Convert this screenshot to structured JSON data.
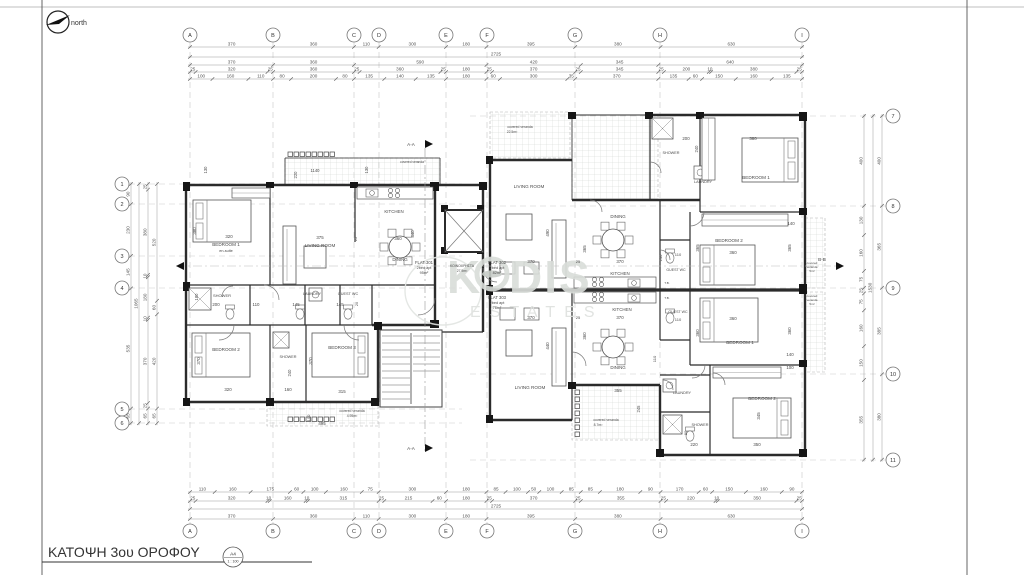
{
  "page": {
    "title": "ΚΑΤΟΨΗ 3ου ΟΡΟΦΟΥ",
    "sheet": "A4",
    "scale_ratio": "1 : 100",
    "north_label": "north"
  },
  "watermark": {
    "brand_k": "K",
    "brand_dis": "DIS",
    "tagline": "ESTATES"
  },
  "grid": {
    "cols": {
      "labels": [
        "A",
        "B",
        "C",
        "D",
        "E",
        "F",
        "G",
        "H",
        "I"
      ],
      "x": [
        190,
        273,
        354,
        379,
        446,
        487,
        575,
        660,
        802
      ]
    },
    "rows_left": {
      "labels": [
        "1",
        "2",
        "3",
        "4",
        "5",
        "6"
      ],
      "y": [
        184,
        204,
        256,
        288,
        409,
        423
      ]
    },
    "rows_right": {
      "labels": [
        "7",
        "8",
        "9",
        "10",
        "11"
      ],
      "y": [
        116,
        206,
        288,
        374,
        460
      ]
    }
  },
  "dim_chains": [
    {
      "name": "top-row-1",
      "dir": "h",
      "x": 190,
      "y": 47,
      "values": [
        370,
        360,
        110,
        300,
        180,
        395,
        380,
        630
      ]
    },
    {
      "name": "top-total",
      "dir": "h",
      "x": 190,
      "y": 57,
      "values": [
        2725
      ]
    },
    {
      "name": "top-row-3",
      "dir": "h",
      "x": 190,
      "y": 65,
      "values": [
        370,
        360,
        590,
        420,
        345,
        640
      ]
    },
    {
      "name": "top-row-4",
      "dir": "h",
      "x": 190,
      "y": 72,
      "values": [
        25,
        320,
        25,
        360,
        25,
        360,
        25,
        180,
        25,
        370,
        25,
        345,
        25,
        200,
        10,
        380,
        25
      ]
    },
    {
      "name": "top-row-5",
      "dir": "h",
      "x": 190,
      "y": 79,
      "values": [
        100,
        160,
        110,
        80,
        200,
        80,
        135,
        140,
        135,
        180,
        60,
        300,
        35,
        370,
        135,
        60,
        150,
        160,
        135
      ]
    },
    {
      "name": "bottom-row-1",
      "dir": "h",
      "x": 190,
      "y": 492,
      "values": [
        110,
        160,
        175,
        60,
        100,
        160,
        75,
        300,
        180,
        85,
        100,
        50,
        100,
        85,
        85,
        180,
        90,
        170,
        60,
        150,
        160,
        90
      ]
    },
    {
      "name": "bottom-row-2",
      "dir": "h",
      "x": 190,
      "y": 501,
      "values": [
        25,
        320,
        10,
        160,
        10,
        315,
        25,
        215,
        60,
        180,
        25,
        370,
        25,
        355,
        25,
        220,
        10,
        350,
        25
      ]
    },
    {
      "name": "bottom-total",
      "dir": "h",
      "x": 190,
      "y": 509,
      "values": [
        2725
      ]
    },
    {
      "name": "bottom-row-4",
      "dir": "h",
      "x": 190,
      "y": 519,
      "values": [
        370,
        360,
        110,
        300,
        180,
        395,
        380,
        630
      ]
    },
    {
      "name": "left-outer",
      "dir": "v",
      "x": 131,
      "y": 184,
      "values": [
        90,
        230,
        145,
        535,
        65
      ]
    },
    {
      "name": "left-total",
      "dir": "v",
      "x": 139,
      "y": 184,
      "values": [
        1065
      ]
    },
    {
      "name": "left-inner",
      "dir": "v",
      "x": 148,
      "y": 184,
      "values": [
        25,
        380,
        10,
        180,
        10,
        370,
        25,
        65
      ]
    },
    {
      "name": "left-room",
      "dir": "v",
      "x": 157,
      "y": 184,
      "values": [
        520,
        60,
        420,
        65
      ]
    },
    {
      "name": "right-inner",
      "dir": "v",
      "x": 864,
      "y": 116,
      "values": [
        400,
        130,
        160,
        75,
        25,
        75,
        160,
        150,
        355
      ]
    },
    {
      "name": "right-total",
      "dir": "v",
      "x": 873,
      "y": 116,
      "values": [
        1530
      ]
    },
    {
      "name": "right-outer",
      "dir": "v",
      "x": 882,
      "y": 116,
      "values": [
        400,
        365,
        385,
        380
      ]
    }
  ],
  "labels": [
    {
      "t": "1140",
      "x": 315,
      "y": 172,
      "s": 4.2
    },
    {
      "t": "220",
      "x": 297,
      "y": 175,
      "s": 4.2,
      "r": -90
    },
    {
      "t": "130",
      "x": 207,
      "y": 170,
      "s": 4.2,
      "r": -90
    },
    {
      "t": "130",
      "x": 368,
      "y": 170,
      "s": 4.2,
      "r": -90
    },
    {
      "t": "covered veranda",
      "x": 412,
      "y": 163,
      "s": 3.2
    },
    {
      "t": "BEDROOM 1",
      "x": 226,
      "y": 246,
      "s": 4.6
    },
    {
      "t": "en-suite",
      "x": 226,
      "y": 252,
      "s": 3.8
    },
    {
      "t": "320",
      "x": 229,
      "y": 238,
      "s": 4.4
    },
    {
      "t": "380",
      "x": 196,
      "y": 231,
      "s": 4.4,
      "r": -90
    },
    {
      "t": "LIVING ROOM",
      "x": 320,
      "y": 247,
      "s": 4.6
    },
    {
      "t": "375",
      "x": 320,
      "y": 239,
      "s": 4.4
    },
    {
      "t": "25",
      "x": 357,
      "y": 239,
      "s": 4,
      "r": -90
    },
    {
      "t": "KITCHEN",
      "x": 394,
      "y": 213,
      "s": 4.4
    },
    {
      "t": "360",
      "x": 398,
      "y": 240,
      "s": 4.4
    },
    {
      "t": "440",
      "x": 414,
      "y": 234,
      "s": 4.4,
      "r": -90
    },
    {
      "t": "DINING",
      "x": 400,
      "y": 261,
      "s": 4.4
    },
    {
      "t": "SHOWER",
      "x": 222,
      "y": 297,
      "s": 4
    },
    {
      "t": "200",
      "x": 216,
      "y": 306,
      "s": 4.4
    },
    {
      "t": "180",
      "x": 198,
      "y": 297,
      "s": 4.2,
      "r": -90
    },
    {
      "t": "110",
      "x": 256,
      "y": 306,
      "s": 4.4
    },
    {
      "t": "LAUNDRY",
      "x": 312,
      "y": 295,
      "s": 3.8
    },
    {
      "t": "145",
      "x": 296,
      "y": 306,
      "s": 4.4
    },
    {
      "t": "GUEST WC",
      "x": 348,
      "y": 295,
      "s": 3.8
    },
    {
      "t": "145",
      "x": 340,
      "y": 306,
      "s": 4.4
    },
    {
      "t": "20",
      "x": 358,
      "y": 304,
      "s": 3.8,
      "r": -90
    },
    {
      "t": "BEDROOM 2",
      "x": 226,
      "y": 351,
      "s": 4.6
    },
    {
      "t": "370",
      "x": 200,
      "y": 361,
      "s": 4.4,
      "r": -90
    },
    {
      "t": "320",
      "x": 228,
      "y": 391,
      "s": 4.4
    },
    {
      "t": "SHOWER",
      "x": 288,
      "y": 358,
      "s": 3.8
    },
    {
      "t": "240",
      "x": 291,
      "y": 373,
      "s": 4.2,
      "r": -90
    },
    {
      "t": "160",
      "x": 288,
      "y": 391,
      "s": 4.4
    },
    {
      "t": "BEDROOM 3",
      "x": 342,
      "y": 349,
      "s": 4.6
    },
    {
      "t": "370",
      "x": 312,
      "y": 361,
      "s": 4.4,
      "r": -90
    },
    {
      "t": "315",
      "x": 342,
      "y": 393,
      "s": 4.4
    },
    {
      "t": "covered veranda",
      "x": 352,
      "y": 412,
      "s": 3.4
    },
    {
      "t": "4.95m²",
      "x": 352,
      "y": 417,
      "s": 3.4
    },
    {
      "t": "495",
      "x": 322,
      "y": 425,
      "s": 4.4
    },
    {
      "t": "100",
      "x": 310,
      "y": 418,
      "s": 4,
      "r": -90
    },
    {
      "t": "FLAT 301",
      "x": 424,
      "y": 264,
      "s": 4.2
    },
    {
      "t": "2bed apt",
      "x": 424,
      "y": 269,
      "s": 3.8
    },
    {
      "t": "95m²",
      "x": 424,
      "y": 274,
      "s": 3.8
    },
    {
      "t": "ΚΟΙΝΟΧΡΗΣΤΑ",
      "x": 462,
      "y": 267,
      "s": 3.4
    },
    {
      "t": "27.9m²",
      "x": 462,
      "y": 272,
      "s": 3.4
    },
    {
      "t": "FLAT 302",
      "x": 497,
      "y": 264,
      "s": 4.2
    },
    {
      "t": "2bed apt",
      "x": 497,
      "y": 269,
      "s": 3.8
    },
    {
      "t": "82m²",
      "x": 497,
      "y": 274,
      "s": 3.8
    },
    {
      "t": "FLAT 303",
      "x": 497,
      "y": 299,
      "s": 4.2
    },
    {
      "t": "2bed apt",
      "x": 497,
      "y": 304,
      "s": 3.8
    },
    {
      "t": "76m²",
      "x": 497,
      "y": 309,
      "s": 3.8
    },
    {
      "t": "A-A",
      "x": 411,
      "y": 146,
      "s": 4.6
    },
    {
      "t": "A-A",
      "x": 411,
      "y": 450,
      "s": 4.6
    },
    {
      "t": "B-B",
      "x": 822,
      "y": 261,
      "s": 4.6
    },
    {
      "t": "covered veranda",
      "x": 520,
      "y": 128,
      "s": 3.4
    },
    {
      "t": "22.5m²",
      "x": 512,
      "y": 133,
      "s": 3.4
    },
    {
      "t": "LIVING ROOM",
      "x": 529,
      "y": 188,
      "s": 4.6
    },
    {
      "t": "490",
      "x": 549,
      "y": 233,
      "s": 4.4,
      "r": -90
    },
    {
      "t": "370",
      "x": 531,
      "y": 263,
      "s": 4.4
    },
    {
      "t": "DINING",
      "x": 618,
      "y": 218,
      "s": 4.4
    },
    {
      "t": "365",
      "x": 586,
      "y": 249,
      "s": 4.4,
      "r": -90
    },
    {
      "t": "25",
      "x": 578,
      "y": 263,
      "s": 4
    },
    {
      "t": "370",
      "x": 620,
      "y": 263,
      "s": 4.4
    },
    {
      "t": "SHOWER",
      "x": 671,
      "y": 154,
      "s": 3.8
    },
    {
      "t": "200",
      "x": 686,
      "y": 140,
      "s": 4.4
    },
    {
      "t": "240",
      "x": 698,
      "y": 149,
      "s": 4.2,
      "r": -90
    },
    {
      "t": "LAUNDRY",
      "x": 703,
      "y": 183,
      "s": 3.8
    },
    {
      "t": "BEDROOM 1",
      "x": 756,
      "y": 179,
      "s": 4.6
    },
    {
      "t": "380",
      "x": 753,
      "y": 140,
      "s": 4.4
    },
    {
      "t": "BEDROOM 2",
      "x": 729,
      "y": 242,
      "s": 4.6
    },
    {
      "t": "360",
      "x": 733,
      "y": 254,
      "s": 4.4
    },
    {
      "t": "365",
      "x": 699,
      "y": 248,
      "s": 4.4,
      "r": -90
    },
    {
      "t": "GUEST WC",
      "x": 676,
      "y": 271,
      "s": 3.6
    },
    {
      "t": "110",
      "x": 678,
      "y": 256,
      "s": 4
    },
    {
      "t": "240",
      "x": 662,
      "y": 258,
      "s": 4,
      "r": -90
    },
    {
      "t": "KITCHEN",
      "x": 620,
      "y": 275,
      "s": 4.4
    },
    {
      "t": "140",
      "x": 791,
      "y": 225,
      "s": 4.4
    },
    {
      "t": "365",
      "x": 791,
      "y": 248,
      "s": 4.4,
      "r": -90
    },
    {
      "t": "covered",
      "x": 812,
      "y": 264,
      "s": 3
    },
    {
      "t": "veranda",
      "x": 812,
      "y": 268,
      "s": 3
    },
    {
      "t": "5m²",
      "x": 812,
      "y": 272,
      "s": 3
    },
    {
      "t": "covered",
      "x": 812,
      "y": 297,
      "s": 3
    },
    {
      "t": "veranda",
      "x": 812,
      "y": 301,
      "s": 3
    },
    {
      "t": "5m²",
      "x": 812,
      "y": 305,
      "s": 3
    },
    {
      "t": "T.B.",
      "x": 667,
      "y": 284,
      "s": 3
    },
    {
      "t": "T.B.",
      "x": 667,
      "y": 299,
      "s": 3
    },
    {
      "t": "KITCHEN",
      "x": 622,
      "y": 311,
      "s": 4.4
    },
    {
      "t": "370",
      "x": 531,
      "y": 319,
      "s": 4.4
    },
    {
      "t": "25",
      "x": 578,
      "y": 319,
      "s": 4
    },
    {
      "t": "370",
      "x": 620,
      "y": 319,
      "s": 4.4
    },
    {
      "t": "GUEST WC",
      "x": 678,
      "y": 313,
      "s": 3.6
    },
    {
      "t": "110",
      "x": 678,
      "y": 321,
      "s": 4
    },
    {
      "t": "360",
      "x": 733,
      "y": 320,
      "s": 4.4
    },
    {
      "t": "360",
      "x": 699,
      "y": 333,
      "s": 4.4,
      "r": -90
    },
    {
      "t": "BEDROOM 1",
      "x": 740,
      "y": 344,
      "s": 4.6
    },
    {
      "t": "360",
      "x": 791,
      "y": 331,
      "s": 4.4,
      "r": -90
    },
    {
      "t": "140",
      "x": 790,
      "y": 356,
      "s": 4.4
    },
    {
      "t": "100",
      "x": 790,
      "y": 369,
      "s": 4.4
    },
    {
      "t": "440",
      "x": 549,
      "y": 346,
      "s": 4.4,
      "r": -90
    },
    {
      "t": "360",
      "x": 586,
      "y": 336,
      "s": 4.4,
      "r": -90
    },
    {
      "t": "DINING",
      "x": 618,
      "y": 369,
      "s": 4.4
    },
    {
      "t": "110",
      "x": 656,
      "y": 359,
      "s": 4,
      "r": -90
    },
    {
      "t": "LIVING ROOM",
      "x": 530,
      "y": 389,
      "s": 4.6
    },
    {
      "t": "355",
      "x": 618,
      "y": 392,
      "s": 4.4
    },
    {
      "t": "245",
      "x": 640,
      "y": 409,
      "s": 4.2,
      "r": -90
    },
    {
      "t": "covered veranda",
      "x": 606,
      "y": 421,
      "s": 3.4
    },
    {
      "t": "8.7m²",
      "x": 598,
      "y": 426,
      "s": 3.4
    },
    {
      "t": "LAUNDRY",
      "x": 682,
      "y": 394,
      "s": 3.8
    },
    {
      "t": "SHOWER",
      "x": 700,
      "y": 426,
      "s": 3.8
    },
    {
      "t": "80",
      "x": 687,
      "y": 433,
      "s": 4,
      "r": -90
    },
    {
      "t": "220",
      "x": 694,
      "y": 446,
      "s": 4.4
    },
    {
      "t": "BEDROOM 2",
      "x": 762,
      "y": 400,
      "s": 4.6
    },
    {
      "t": "345",
      "x": 760,
      "y": 416,
      "s": 4.4,
      "r": -90
    },
    {
      "t": "350",
      "x": 757,
      "y": 446,
      "s": 4.4
    }
  ]
}
